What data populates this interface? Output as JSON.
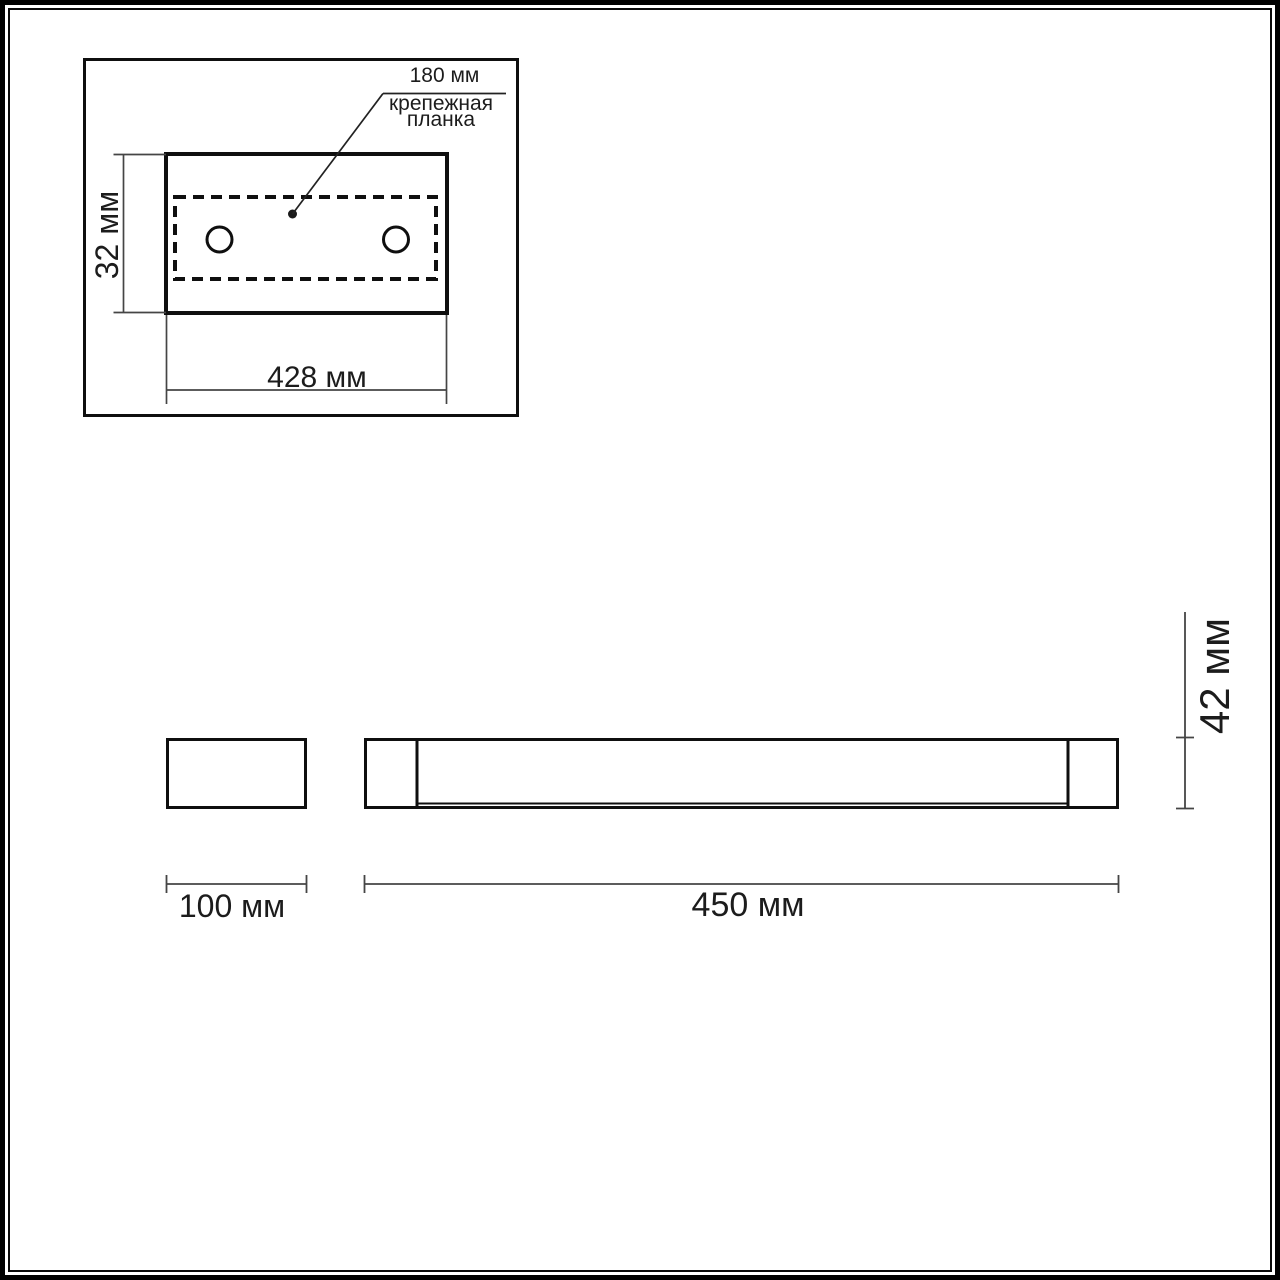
{
  "colors": {
    "background": "#ffffff",
    "line": "#141414",
    "dim_line": "#454545",
    "text": "#1c1c1c"
  },
  "top_view": {
    "callout": {
      "value": "180 мм",
      "label_lines": [
        "крепежная",
        "планка"
      ]
    },
    "dims": {
      "height": "32 мм",
      "width": "428 мм"
    }
  },
  "side_view": {
    "dims": {
      "height": "42 мм",
      "depth": "100 мм",
      "length": "450 мм"
    }
  }
}
